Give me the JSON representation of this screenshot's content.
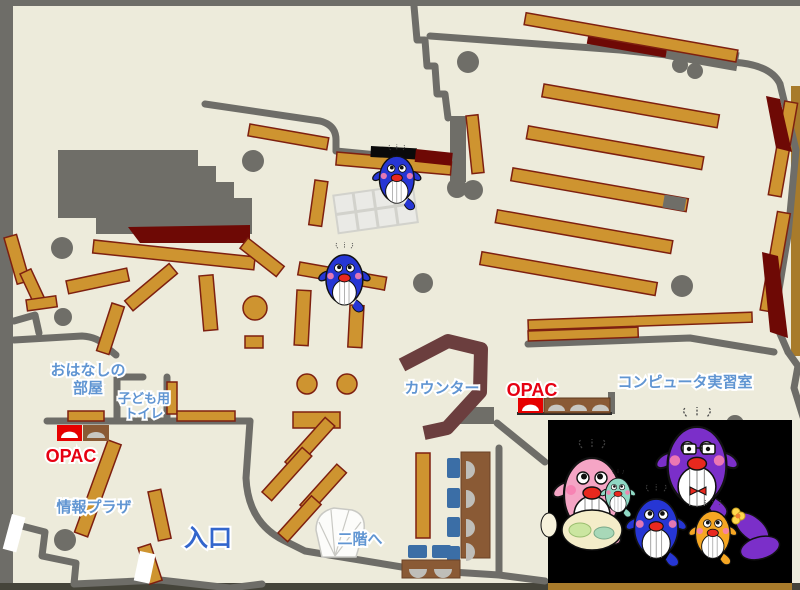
{
  "map": {
    "labels": {
      "storytelling_room_line1": "おはなしの",
      "storytelling_room_line2": "部屋",
      "kids_toilet_line1": "子ども用",
      "kids_toilet_line2": "トイレ",
      "opac_left": "OPAC",
      "info_plaza": "情報プラザ",
      "entrance": "入口",
      "to_second_floor": "二階へ",
      "counter": "カウンター",
      "opac_right": "OPAC",
      "computer_room": "コンピュータ実習室"
    },
    "colors": {
      "floor": "#EDEBDB",
      "wall_gray": "#6E6D68",
      "bookshelf": "#CE9430",
      "bookshelf_border": "#7E2010",
      "dark_red_area": "#6E0905",
      "counter_brown": "#6B3E3E",
      "desk_brown": "#8A5A35",
      "chair_blue": "#3B6EA6",
      "seat_gray": "#BFBEB9",
      "label_blue": "#6095D2",
      "entrance_blue": "#3366CC",
      "opac_red": "#E60012",
      "mascot_panel": "#000000",
      "mascot_blue": "#2636D4",
      "mascot_pink": "#F5A5C5",
      "mascot_purple": "#7B2FC9",
      "mascot_orange": "#F5A623",
      "mascot_teal": "#8FD8C4"
    },
    "mascots": {
      "floor": [
        "blue-whale-mascot",
        "blue-whale-mascot"
      ],
      "family_panel": [
        "pink-whale-mother",
        "teal-whale-baby",
        "blue-whale-child",
        "purple-whale-father",
        "orange-whale-child"
      ]
    }
  }
}
